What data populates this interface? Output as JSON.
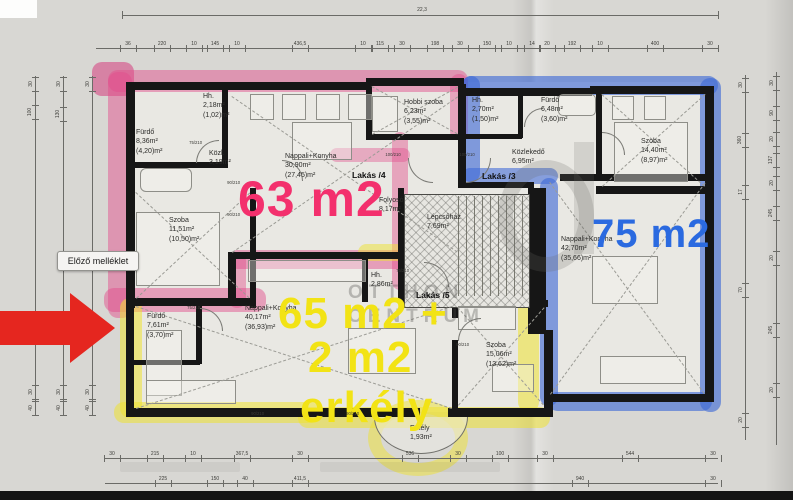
{
  "ui": {
    "tooltip_label": "Előző melléklet"
  },
  "plan": {
    "watermark": {
      "line1": "OTTHON",
      "line2": "CENTRUM"
    },
    "apartment_tags": [
      {
        "text": "Lakás /4",
        "x": 352,
        "y": 170
      },
      {
        "text": "Lakás /3",
        "x": 482,
        "y": 171
      },
      {
        "text": "Lakás /5",
        "x": 416,
        "y": 290
      }
    ],
    "area_labels": [
      {
        "text": "63 m2",
        "x": 238,
        "y": 174,
        "size": 50,
        "weight": 600,
        "color": "#f3306d"
      },
      {
        "text": "75 m2",
        "x": 592,
        "y": 214,
        "size": 40,
        "weight": 700,
        "color": "#2b6ae0"
      },
      {
        "text": "65 m2 +",
        "x": 278,
        "y": 292,
        "size": 44,
        "weight": 700,
        "color": "#f2e315"
      },
      {
        "text": "2 m2",
        "x": 308,
        "y": 336,
        "size": 44,
        "weight": 700,
        "color": "#f2e315"
      },
      {
        "text": "erkély",
        "x": 300,
        "y": 386,
        "size": 44,
        "weight": 700,
        "color": "#f2e315"
      }
    ],
    "rooms": [
      {
        "lines": [
          "Hh.",
          "2,18m²",
          "(1,02)m²"
        ],
        "x": 203,
        "y": 92
      },
      {
        "lines": [
          "Fürdő",
          "8,36m²",
          "(4,20)m²"
        ],
        "x": 136,
        "y": 128
      },
      {
        "lines": [
          "Közl.",
          "3,19m²"
        ],
        "x": 209,
        "y": 149
      },
      {
        "lines": [
          "Nappali+Konyha",
          "30,90m²",
          "(27,45)m²"
        ],
        "x": 285,
        "y": 152
      },
      {
        "lines": [
          "Szoba",
          "11,51m²",
          "(10,50)m²"
        ],
        "x": 169,
        "y": 216
      },
      {
        "lines": [
          "Hobbi szoba",
          "6,23m²",
          "(3,55)m²"
        ],
        "x": 404,
        "y": 98
      },
      {
        "lines": [
          "Folyosó",
          "8,17m²"
        ],
        "x": 379,
        "y": 196
      },
      {
        "lines": [
          "Hh.",
          "2,70m²",
          "(1,50)m²"
        ],
        "x": 472,
        "y": 96
      },
      {
        "lines": [
          "Fürdő",
          "6,48m²",
          "(3,60)m²"
        ],
        "x": 541,
        "y": 96
      },
      {
        "lines": [
          "Közlekedő",
          "6,95m²"
        ],
        "x": 512,
        "y": 148
      },
      {
        "lines": [
          "Szoba",
          "14,40m²",
          "(8,97)m²"
        ],
        "x": 641,
        "y": 137
      },
      {
        "lines": [
          "Lépcsőház",
          "7,69m²"
        ],
        "x": 427,
        "y": 213
      },
      {
        "lines": [
          "Nappali+Konyha",
          "42,70m²",
          "(35,66)m²"
        ],
        "x": 561,
        "y": 235
      },
      {
        "lines": [
          "Fürdő",
          "7,61m²",
          "(3,70)m²"
        ],
        "x": 147,
        "y": 312
      },
      {
        "lines": [
          "Nappali+Konyha",
          "40,17m²",
          "(36,93)m²"
        ],
        "x": 245,
        "y": 304
      },
      {
        "lines": [
          "Hh.",
          "2,86m²"
        ],
        "x": 371,
        "y": 271
      },
      {
        "lines": [
          "Szoba",
          "15,06m²",
          "(13,62)m²"
        ],
        "x": 486,
        "y": 341
      },
      {
        "lines": [
          "Erkély",
          "1,93m²"
        ],
        "x": 410,
        "y": 424
      }
    ],
    "door_labels": [
      {
        "text": "75/210",
        "x": 188,
        "y": 140
      },
      {
        "text": "90/210",
        "x": 226,
        "y": 180
      },
      {
        "text": "90/210",
        "x": 226,
        "y": 212
      },
      {
        "text": "100/210",
        "x": 384,
        "y": 152
      },
      {
        "text": "100/210",
        "x": 458,
        "y": 152
      },
      {
        "text": "75/210",
        "x": 395,
        "y": 268
      },
      {
        "text": "90/210",
        "x": 455,
        "y": 342
      },
      {
        "text": "75/210",
        "x": 186,
        "y": 305
      },
      {
        "text": "90/210",
        "x": 250,
        "y": 411
      },
      {
        "text": "90/210",
        "x": 345,
        "y": 411
      }
    ],
    "highlight_colors": {
      "pink": "rgba(226,77,140,0.48)",
      "yellow": "rgba(238,226,50,0.55)",
      "blue": "rgba(62,105,215,0.62)"
    }
  },
  "dimensions": {
    "top_total": {
      "text": "22,3",
      "x": 422,
      "y": 13
    },
    "top_chain": {
      "y": 48,
      "labels": [
        {
          "x": 128,
          "t": "36"
        },
        {
          "x": 162,
          "t": "220"
        },
        {
          "x": 194,
          "t": "10"
        },
        {
          "x": 215,
          "t": "145"
        },
        {
          "x": 237,
          "t": "10"
        },
        {
          "x": 300,
          "t": "436,5"
        },
        {
          "x": 363,
          "t": "10"
        },
        {
          "x": 380,
          "t": "115"
        },
        {
          "x": 402,
          "t": "30"
        },
        {
          "x": 435,
          "t": "198"
        },
        {
          "x": 460,
          "t": "30"
        },
        {
          "x": 487,
          "t": "150"
        },
        {
          "x": 509,
          "t": "10"
        },
        {
          "x": 532,
          "t": "14"
        },
        {
          "x": 547,
          "t": "20"
        },
        {
          "x": 572,
          "t": "192"
        },
        {
          "x": 600,
          "t": "10"
        },
        {
          "x": 655,
          "t": "400"
        },
        {
          "x": 710,
          "t": "30"
        }
      ]
    },
    "bottom_chain1": {
      "y": 458,
      "labels": [
        {
          "x": 112,
          "t": "30"
        },
        {
          "x": 155,
          "t": "215"
        },
        {
          "x": 193,
          "t": "10"
        },
        {
          "x": 242,
          "t": "367,5"
        },
        {
          "x": 300,
          "t": "30"
        },
        {
          "x": 410,
          "t": "536"
        },
        {
          "x": 458,
          "t": "30"
        },
        {
          "x": 500,
          "t": "100"
        },
        {
          "x": 545,
          "t": "30"
        },
        {
          "x": 630,
          "t": "544"
        },
        {
          "x": 713,
          "t": "30"
        }
      ]
    },
    "bottom_chain2": {
      "y": 483,
      "labels": [
        {
          "x": 163,
          "t": "225"
        },
        {
          "x": 215,
          "t": "150"
        },
        {
          "x": 245,
          "t": "40"
        },
        {
          "x": 300,
          "t": "411,5"
        },
        {
          "x": 580,
          "t": "940"
        },
        {
          "x": 713,
          "t": "30"
        }
      ]
    },
    "left_chains": [
      {
        "x": 35,
        "y1": 76,
        "y2": 416,
        "labels": [
          {
            "y": 84,
            "t": "30"
          },
          {
            "y": 112,
            "t": "100"
          },
          {
            "y": 392,
            "t": "30"
          },
          {
            "y": 408,
            "t": "40"
          }
        ]
      },
      {
        "x": 63,
        "y1": 76,
        "y2": 416,
        "labels": [
          {
            "y": 84,
            "t": "30"
          },
          {
            "y": 114,
            "t": "130"
          },
          {
            "y": 392,
            "t": "30"
          },
          {
            "y": 408,
            "t": "40"
          }
        ]
      },
      {
        "x": 92,
        "y1": 76,
        "y2": 416,
        "labels": [
          {
            "y": 84,
            "t": "30"
          },
          {
            "y": 392,
            "t": "30"
          },
          {
            "y": 408,
            "t": "40"
          }
        ]
      }
    ],
    "right_chains": [
      {
        "x": 745,
        "y1": 75,
        "y2": 440,
        "labels": [
          {
            "y": 85,
            "t": "30"
          },
          {
            "y": 140,
            "t": "360"
          },
          {
            "y": 192,
            "t": "17"
          },
          {
            "y": 290,
            "t": "70"
          },
          {
            "y": 420,
            "t": "20"
          }
        ]
      },
      {
        "x": 776,
        "y1": 72,
        "y2": 445,
        "labels": [
          {
            "y": 83,
            "t": "30"
          },
          {
            "y": 113,
            "t": "90"
          },
          {
            "y": 139,
            "t": "20"
          },
          {
            "y": 160,
            "t": "137"
          },
          {
            "y": 183,
            "t": "20"
          },
          {
            "y": 213,
            "t": "245"
          },
          {
            "y": 258,
            "t": "20"
          },
          {
            "y": 330,
            "t": "245"
          },
          {
            "y": 390,
            "t": "20"
          }
        ]
      }
    ]
  }
}
